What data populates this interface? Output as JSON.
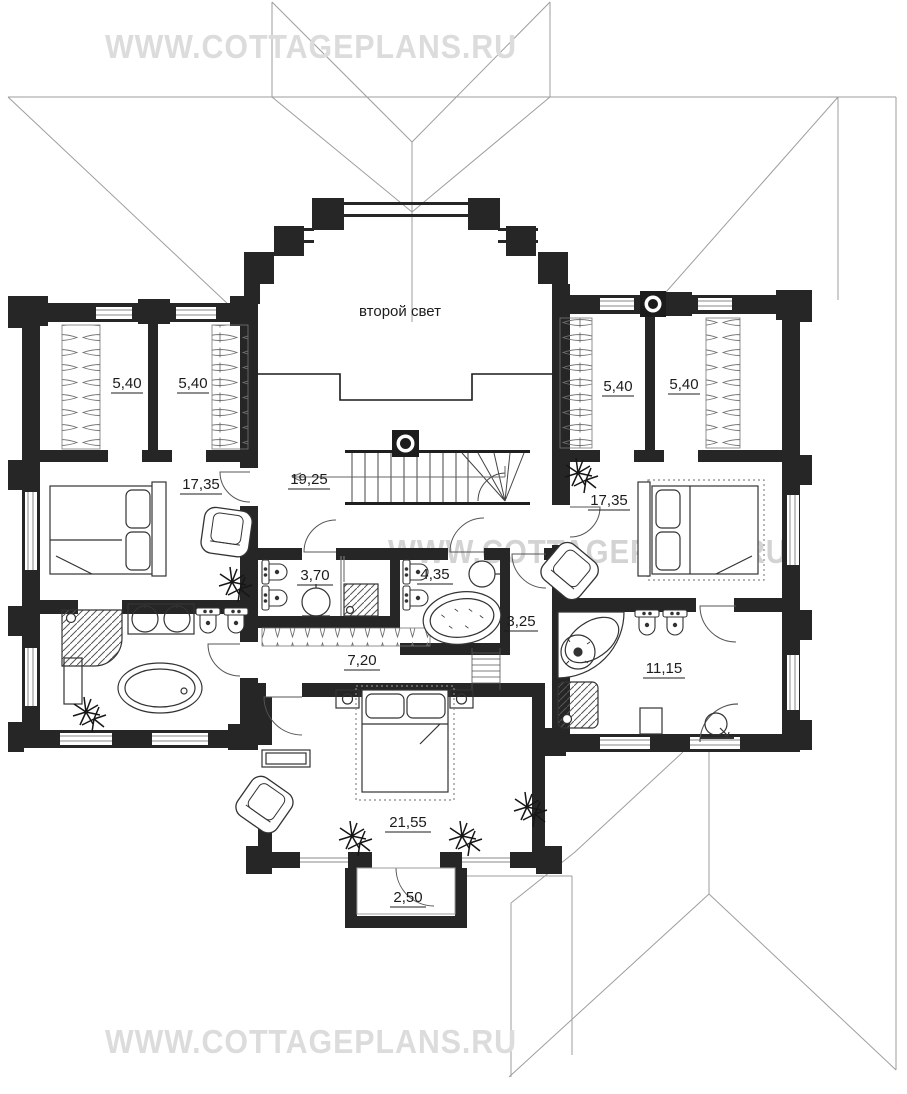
{
  "watermarks": {
    "top": "WWW.COTTAGEPLANS.RU",
    "middle": "WWW.COTTAGEPLANS.RU",
    "bottom": "WWW.COTTAGEPLANS.RU"
  },
  "notes": {
    "second_light": "второй свет"
  },
  "rooms": {
    "closet_left_a": {
      "area": "5,40"
    },
    "closet_left_b": {
      "area": "5,40"
    },
    "closet_right_a": {
      "area": "5,40"
    },
    "closet_right_b": {
      "area": "5,40"
    },
    "bedroom_left": {
      "area": "17,35"
    },
    "hall": {
      "area": "19,25"
    },
    "bedroom_right": {
      "area": "17,35"
    },
    "bathroom_center_small": {
      "area": "3,70"
    },
    "bathroom_center_large": {
      "area": "4,35"
    },
    "corridor_vertical": {
      "area": "3,25"
    },
    "corridor": {
      "area": "7,20"
    },
    "bathroom_right": {
      "area": "11,15"
    },
    "bedroom_master": {
      "area": "21,55"
    },
    "balcony": {
      "area": "2,50"
    }
  },
  "colors": {
    "wall": "#262626",
    "roof_line": "#9e9e9e",
    "watermark": "#dcdcdc",
    "furniture": "#333333"
  }
}
